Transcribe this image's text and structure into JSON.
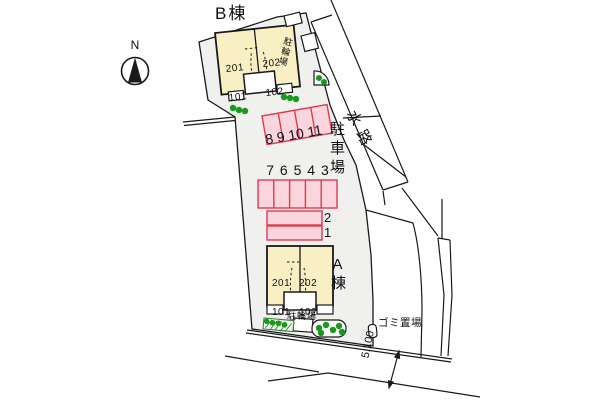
{
  "site": {
    "compass": {
      "label": "N"
    },
    "buildings": {
      "b": {
        "name": "B棟",
        "unit_left_upper": "201",
        "unit_left_lower": "101",
        "unit_right_upper": "202",
        "unit_right_lower": "102",
        "bicycle_label": "駐輪場"
      },
      "a": {
        "name": "A棟",
        "unit_left_upper": "201",
        "unit_left_lower": "101",
        "unit_right_upper": "202",
        "unit_right_lower": "102",
        "bicycle_label": "駐輪場"
      }
    },
    "parking": {
      "label": "駐車場",
      "row_top_numbers": "8 9 10 11",
      "row_mid_numbers": "7 6 5 4 3",
      "space_2": "2",
      "space_1": "1"
    },
    "surroundings": {
      "waterway_label": "水路",
      "garbage_label": "ゴミ置場",
      "road_dimension": "5.100"
    }
  },
  "colors": {
    "site_gray": "#f0f0ef",
    "building_cream": "#f8f0c4",
    "parking_pink": "#fbd5de",
    "parking_red": "#e03a4e",
    "green_dot": "#18991d",
    "hedge_green": "#2f7d2f",
    "line_black": "#1a1a1a"
  }
}
